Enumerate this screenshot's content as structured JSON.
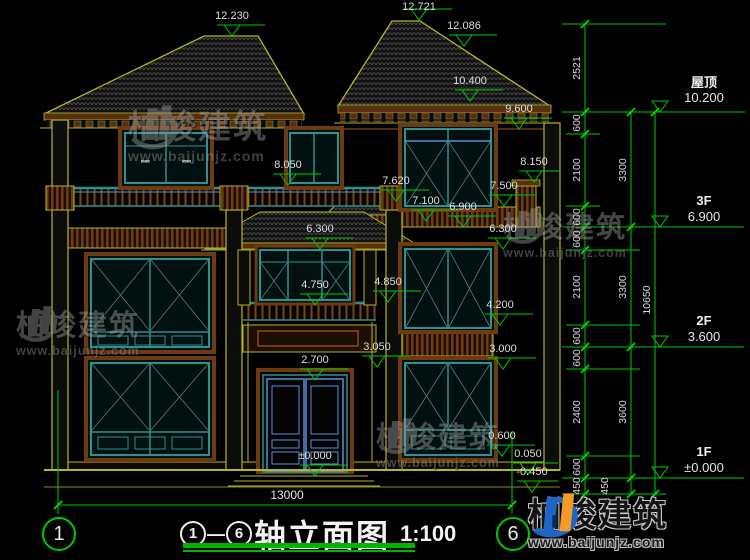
{
  "title": {
    "axis_start": "1",
    "separator": "—",
    "axis_end": "6",
    "name": "轴立面图",
    "scale": "1:100"
  },
  "floors": [
    {
      "name": "屋顶",
      "elevation": "10.200"
    },
    {
      "name": "3F",
      "elevation": "6.900"
    },
    {
      "name": "2F",
      "elevation": "3.600"
    },
    {
      "name": "1F",
      "elevation": "±0.000"
    }
  ],
  "markers": [
    "12.230",
    "12.721",
    "12.086",
    "10.400",
    "9.600",
    "8.050",
    "8.150",
    "7.620",
    "7.500",
    "7.100",
    "6.900",
    "6.300",
    "6.300",
    "4.750",
    "4.850",
    "4.200",
    "3.050",
    "3.000",
    "2.700",
    "0.600",
    "0.050",
    "-0.450",
    "±0.000"
  ],
  "chains": {
    "inner": [
      "2521",
      "600",
      "2100",
      "600",
      "600",
      "2100",
      "600",
      "600",
      "2400",
      "600",
      "450"
    ],
    "middle": [
      "3300",
      "3300",
      "3600",
      "450"
    ],
    "outer": [
      "10650"
    ]
  },
  "overall_width": "13000",
  "axes": {
    "start": "1",
    "end": "6"
  },
  "watermark": {
    "name": "柏竣建筑",
    "url": "www.baijunjz.com"
  },
  "logo": {
    "name": "柏竣建筑",
    "url": "www.baijunjz.com"
  },
  "colors": {
    "line_green": "#00c800",
    "line_yellow": "#b5b52a",
    "wood_brown": "#6e3a12",
    "window_teal": "#2e9090",
    "accent_blue": "#5b8dd6",
    "logo_blue": "#1f66c4",
    "logo_orange": "#f59a23"
  }
}
